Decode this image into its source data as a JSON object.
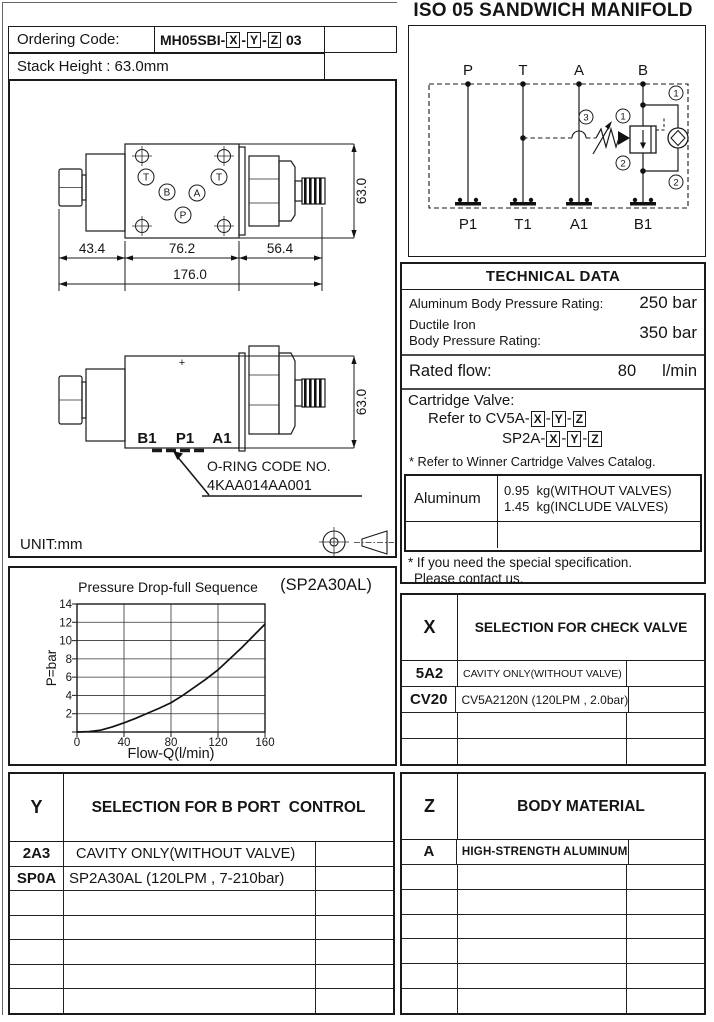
{
  "header": {
    "title": "ISO 05 SANDWICH MANIFOLD",
    "ordering_label": "Ordering Code:",
    "ordering_prefix": "MH05SBI-",
    "ordering_sep": "-",
    "ordering_suffix": " 03",
    "stack_height": "Stack Height : 63.0mm"
  },
  "codes": {
    "x": "X",
    "y": "Y",
    "z": "Z"
  },
  "schematic": {
    "top_ports": [
      "P",
      "T",
      "A",
      "B"
    ],
    "bottom_ports": [
      "P1",
      "T1",
      "A1",
      "B1"
    ],
    "balloons": {
      "top_right": "1",
      "valve_in": "1",
      "valve_out": "2",
      "bottom_right": "2",
      "adjust": "3"
    }
  },
  "drawing": {
    "dim_43": "43.4",
    "dim_76": "76.2",
    "dim_56": "56.4",
    "dim_total": "176.0",
    "dim_height_top": "63.0",
    "dim_height_side": "63.0",
    "ports_top": {
      "t_left": "T",
      "t_right": "T",
      "b": "B",
      "a": "A",
      "p": "P"
    },
    "ports_side": [
      "B1",
      "P1",
      "A1"
    ],
    "plus_mark": "+",
    "oring_line1": "O-RING CODE NO.",
    "oring_line2": "4KAA014AA001",
    "unit_label": "UNIT:mm"
  },
  "technical": {
    "title": "TECHNICAL DATA",
    "row1_label": "Aluminum Body Pressure Rating:",
    "row1_value": "250 bar",
    "row2_label_a": "Ductile Iron",
    "row2_label_b": "Body Pressure Rating:",
    "row2_value": "350 bar",
    "row3_label": "Rated flow:",
    "row3_value": "80",
    "row3_unit": "l/min",
    "cartridge_label": "Cartridge Valve:",
    "cartridge_ref1": "Refer to CV5A-",
    "cartridge_ref2": "SP2A-",
    "cartridge_sep": "-",
    "catalog_note": "* Refer to Winner Cartridge Valves Catalog.",
    "weight_material": "Aluminum",
    "weight_line1": "0.95  kg(WITHOUT VALVES)",
    "weight_line2": "1.45  kg(INCLUDE VALVES)",
    "special_note1": "* If you need the special specification.",
    "special_note2": "Please contact us."
  },
  "selection_x": {
    "key": "X",
    "title": "SELECTION FOR CHECK VALVE",
    "rows": [
      {
        "code": "5A2",
        "desc": "CAVITY ONLY(WITHOUT VALVE)"
      },
      {
        "code": "CV20",
        "desc": "CV5A2120N (120LPM , 2.0bar)"
      },
      {
        "code": "",
        "desc": ""
      },
      {
        "code": "",
        "desc": ""
      }
    ]
  },
  "selection_y": {
    "key": "Y",
    "title": "SELECTION FOR B PORT  CONTROL",
    "rows": [
      {
        "code": "2A3",
        "desc": "CAVITY ONLY(WITHOUT VALVE)"
      },
      {
        "code": "SP0A",
        "desc": "SP2A30AL (120LPM , 7-210bar)"
      },
      {
        "code": "",
        "desc": ""
      },
      {
        "code": "",
        "desc": ""
      },
      {
        "code": "",
        "desc": ""
      },
      {
        "code": "",
        "desc": ""
      },
      {
        "code": "",
        "desc": ""
      }
    ]
  },
  "selection_z": {
    "key": "Z",
    "title": "BODY MATERIAL",
    "rows": [
      {
        "code": "A",
        "desc": "HIGH-STRENGTH ALUMINUM"
      },
      {
        "code": "",
        "desc": ""
      },
      {
        "code": "",
        "desc": ""
      },
      {
        "code": "",
        "desc": ""
      },
      {
        "code": "",
        "desc": ""
      },
      {
        "code": "",
        "desc": ""
      },
      {
        "code": "",
        "desc": ""
      }
    ]
  },
  "chart_data": {
    "type": "line",
    "title": "Pressure Drop-full Sequence",
    "annotation": "(SP2A30AL)",
    "xlabel": "Flow-Q(l/min)",
    "ylabel": "P=bar",
    "xlim": [
      0,
      160
    ],
    "ylim": [
      0,
      14
    ],
    "xticks": [
      0,
      40,
      80,
      120,
      160
    ],
    "yticks": [
      2,
      4,
      6,
      8,
      10,
      12,
      14
    ],
    "grid": true,
    "series": [
      {
        "name": "SP2A30AL",
        "x": [
          0,
          10,
          20,
          30,
          40,
          50,
          60,
          70,
          80,
          90,
          100,
          110,
          120,
          130,
          140,
          150,
          160
        ],
        "y": [
          0,
          0.05,
          0.2,
          0.55,
          1.0,
          1.5,
          2.05,
          2.6,
          3.2,
          4.0,
          4.9,
          5.8,
          6.8,
          8.0,
          9.2,
          10.5,
          11.8
        ]
      }
    ]
  }
}
